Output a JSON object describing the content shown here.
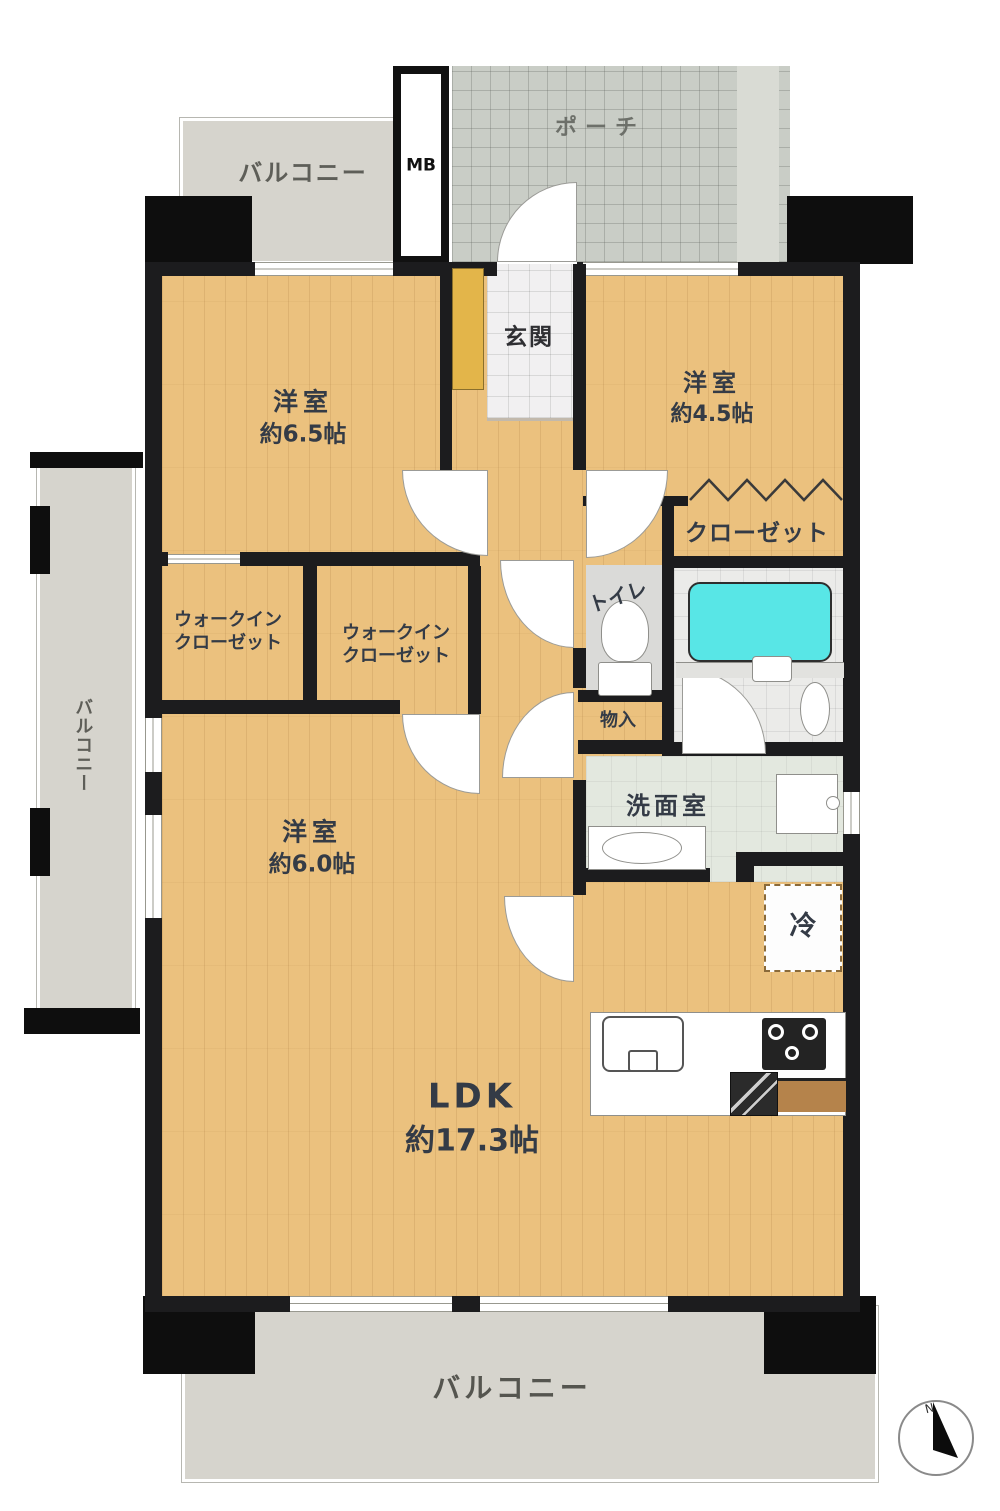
{
  "floorplan": {
    "type": "apartment-floor-plan",
    "rooms": {
      "balcony_top": {
        "label": "バルコニー"
      },
      "meter_box": {
        "label": "MB"
      },
      "porch": {
        "label": "ポーチ"
      },
      "entrance": {
        "label": "玄関"
      },
      "bedroom_nw": {
        "label": "洋室",
        "size": "約6.5帖"
      },
      "bedroom_ne": {
        "label": "洋室",
        "size": "約4.5帖"
      },
      "closet": {
        "label": "クローゼット"
      },
      "toilet": {
        "label": "トイレ"
      },
      "wic_west": {
        "line1": "ウォークイン",
        "line2": "クローゼット"
      },
      "wic_east": {
        "line1": "ウォークイン",
        "line2": "クローゼット"
      },
      "storage": {
        "label": "物入"
      },
      "washroom": {
        "label": "洗面室"
      },
      "bedroom_sw": {
        "label": "洋室",
        "size": "約6.0帖"
      },
      "refrigerator": {
        "label": "冷"
      },
      "ldk": {
        "label": "LDK",
        "size": "約17.3帖"
      },
      "balcony_left": {
        "label": "バルコニー"
      },
      "balcony_bottom": {
        "label": "バルコニー"
      }
    },
    "compass": {
      "north_label": "N"
    },
    "colors": {
      "wood_floor": "#ebc17e",
      "bathtub": "#58e6e6",
      "wall": "#1c1c1e",
      "balcony": "#d6d4cd",
      "porch_tile": "#c9cdc6",
      "shoe_cabinet": "#e3b54a",
      "label_text": "#343b46"
    }
  }
}
